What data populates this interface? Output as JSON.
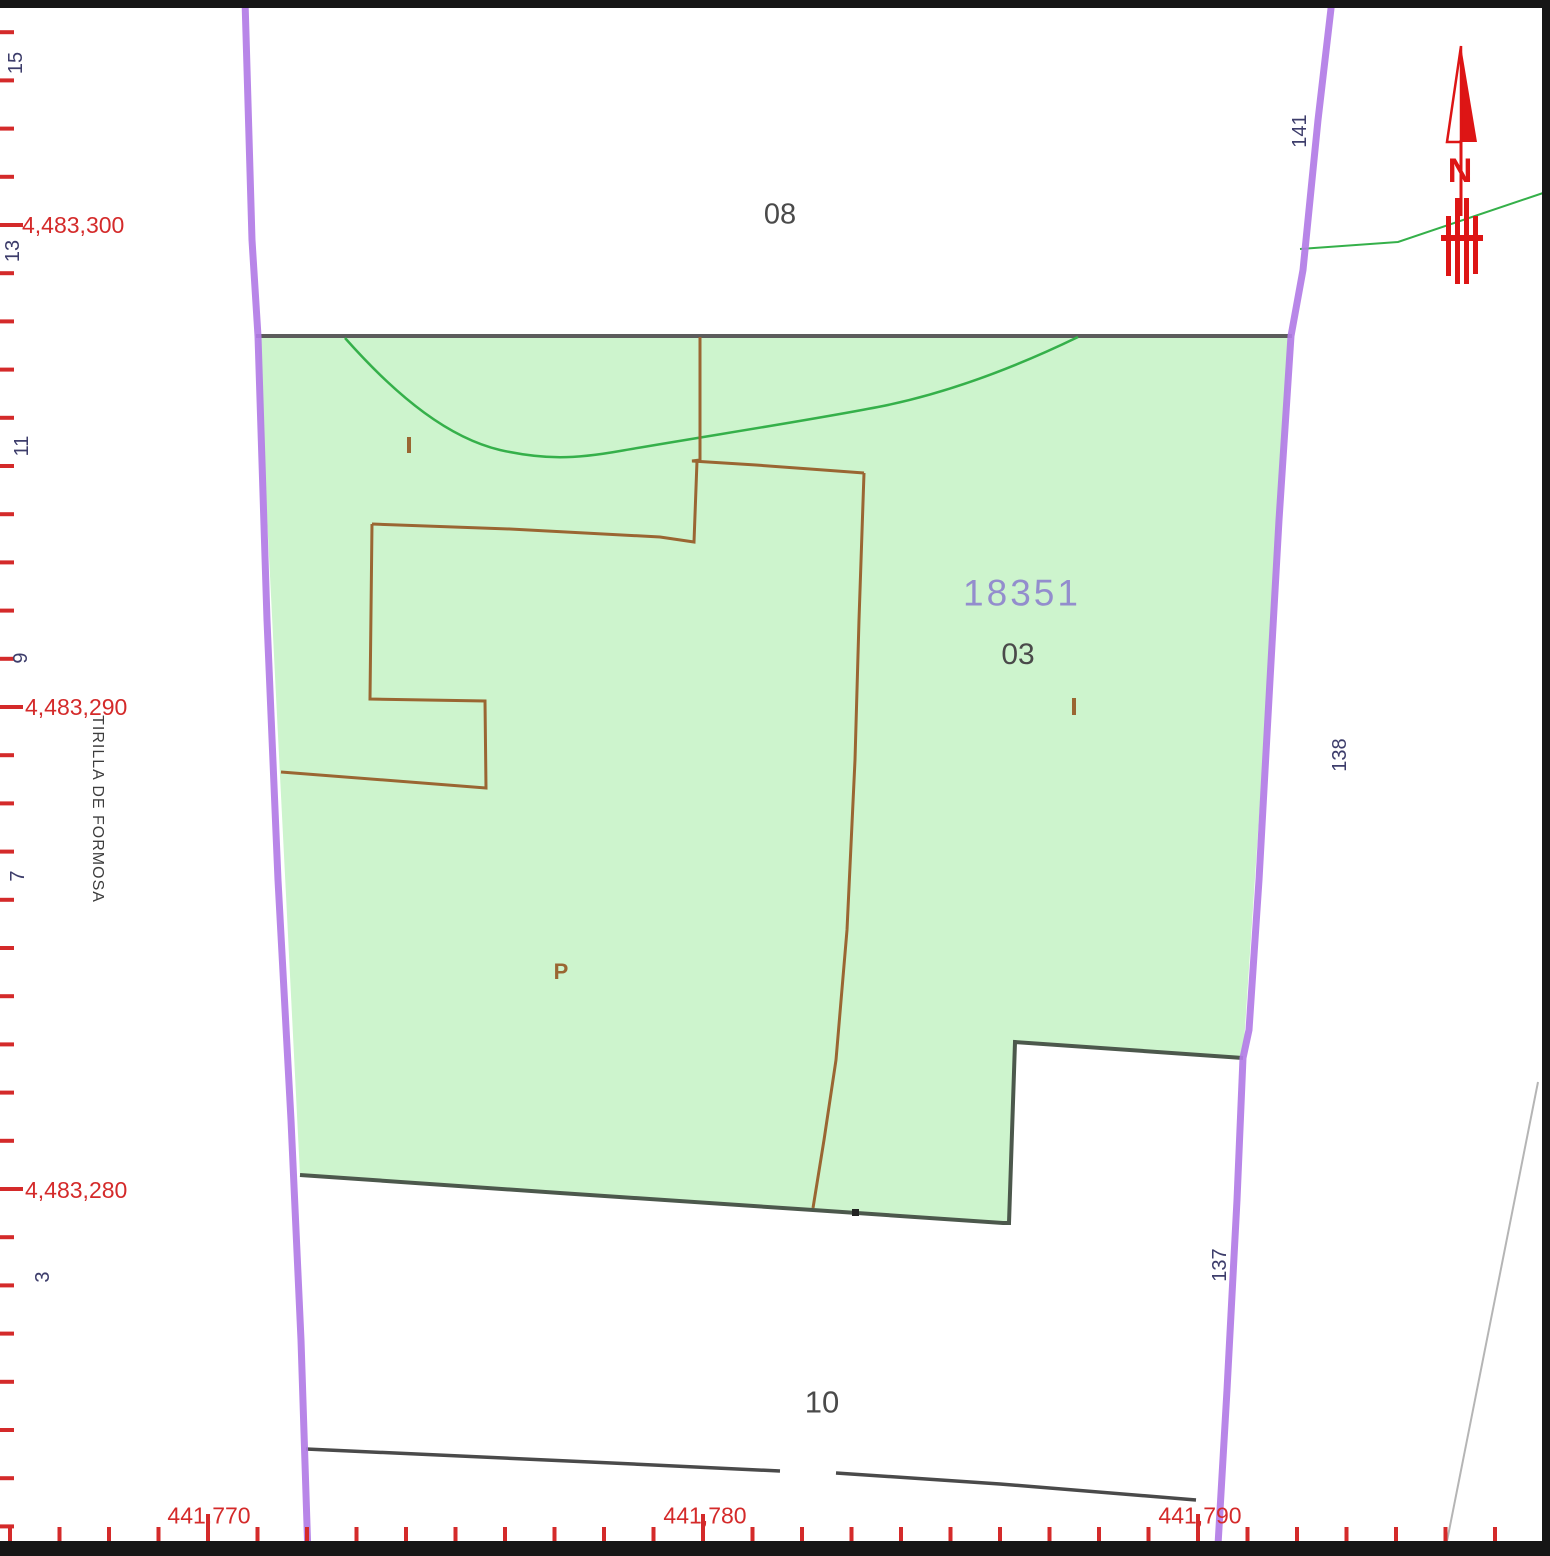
{
  "map": {
    "parcel_main": {
      "id": "18351",
      "subparcel": "03",
      "p_label": "P"
    },
    "parcel_north": {
      "id": "08"
    },
    "parcel_south": {
      "id": "10"
    },
    "street": {
      "name": "TIRILLA DE FORMOSA",
      "numbers_left": [
        "15",
        "13",
        "11",
        "9",
        "7",
        "3"
      ],
      "numbers_right": [
        "141",
        "138",
        "137"
      ]
    },
    "north_arrow": {
      "label": "N"
    },
    "axes": {
      "y_labels": [
        "4,483,300",
        "4,483,290",
        "4,483,280"
      ],
      "x_labels": [
        "441,770",
        "441,780",
        "441,790"
      ]
    },
    "colors": {
      "parcel_fill": "#cdf4cd",
      "parcel_boundary": "#4c584c",
      "cadastral_purple": "#b27ce6",
      "subparcel_brown": "#9a6632",
      "tick_red": "#d42a2a",
      "north_red": "#dd1515",
      "number_navy": "#3d3d6b",
      "parcel_id_purple": "#938dcd",
      "label_gray": "#4a4a4a",
      "vegetation_green": "#35b04a"
    }
  }
}
